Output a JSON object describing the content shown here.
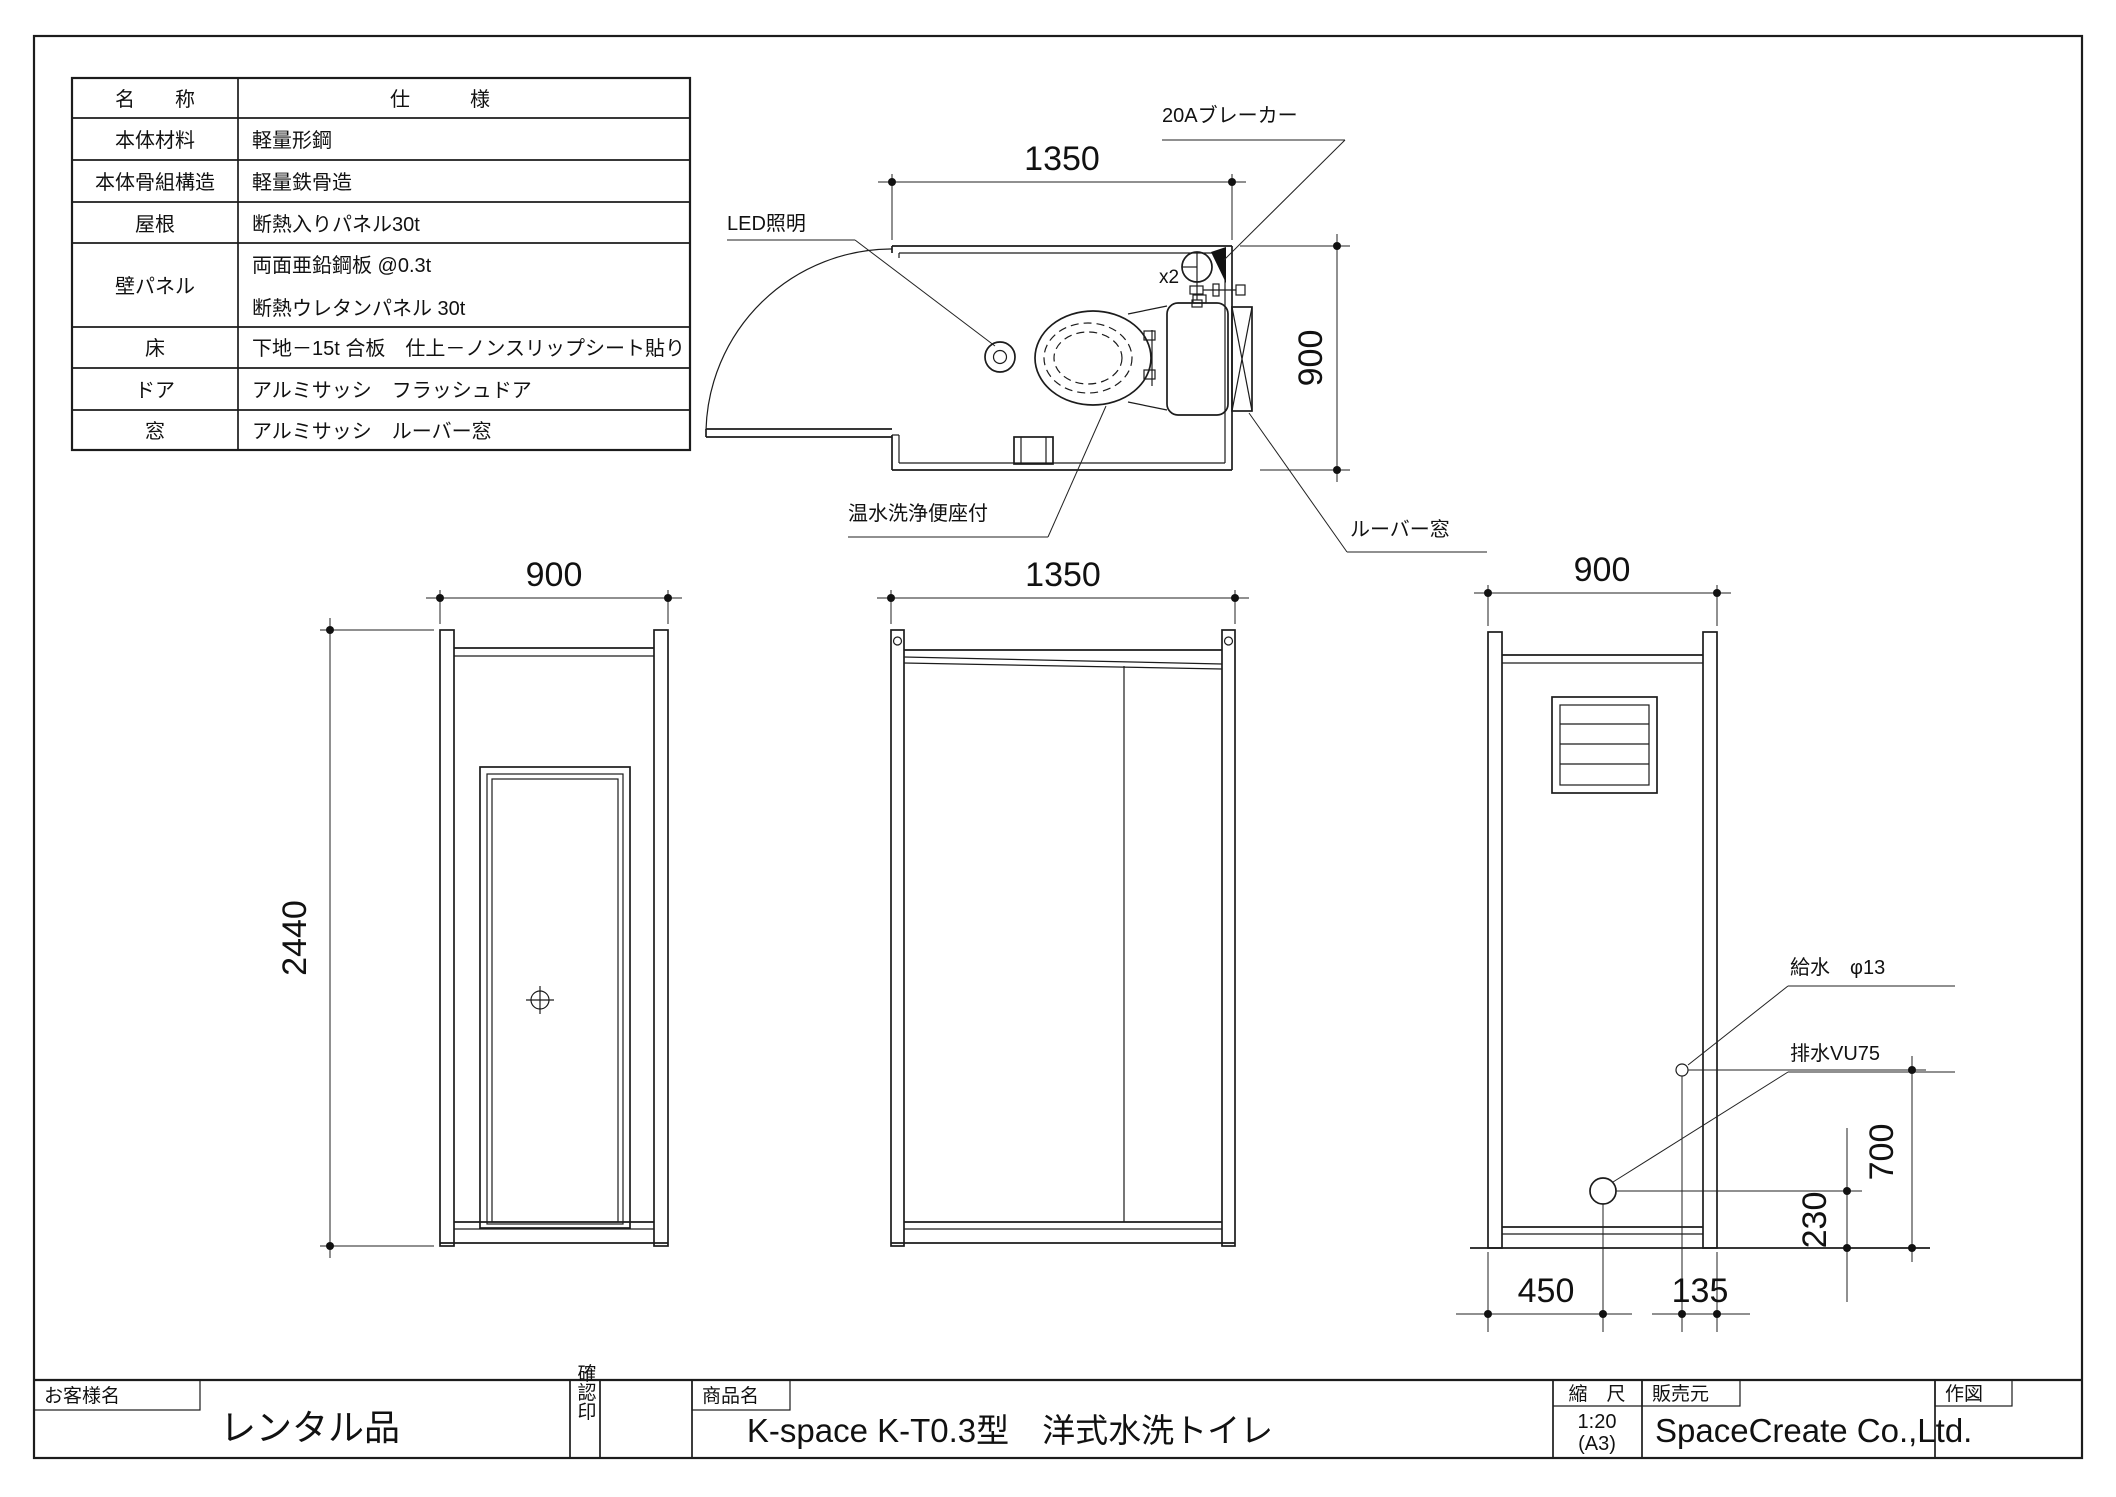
{
  "spec_table": {
    "headers": {
      "name": "名　　称",
      "spec": "仕　　　様"
    },
    "rows": [
      {
        "name": "本体材料",
        "spec": "軽量形鋼"
      },
      {
        "name": "本体骨組構造",
        "spec": "軽量鉄骨造"
      },
      {
        "name": "屋根",
        "spec": "断熱入りパネル30t"
      },
      {
        "name": "壁パネル",
        "spec_lines": [
          "両面亜鉛鋼板 @0.3t",
          "断熱ウレタンパネル 30t"
        ]
      },
      {
        "name": "床",
        "spec": "下地－15t 合板　仕上－ノンスリップシート貼り"
      },
      {
        "name": "ドア",
        "spec": "アルミサッシ　フラッシュドア"
      },
      {
        "name": "窓",
        "spec": "アルミサッシ　ルーバー窓"
      }
    ]
  },
  "plan_view": {
    "dim_width": "1350",
    "dim_depth": "900",
    "label_led": "LED照明",
    "label_breaker": "20Aブレーカー",
    "label_breaker_qty": "x2",
    "label_toilet": "温水洗浄便座付",
    "label_louver": "ルーバー窓"
  },
  "elevation_front": {
    "dim_width": "900",
    "dim_height": "2440"
  },
  "elevation_side": {
    "dim_width": "1350"
  },
  "elevation_rear": {
    "dim_width": "900",
    "label_supply": "給水　φ13",
    "label_drain": "排水VU75",
    "dim_700": "700",
    "dim_230": "230",
    "dim_450": "450",
    "dim_135": "135"
  },
  "title_block": {
    "customer_label": "お客様名",
    "customer_value": "レンタル品",
    "stamp_label": "確認印",
    "product_label": "商品名",
    "product_value": "K-space K-T0.3型　洋式水洗トイレ",
    "scale_label": "縮　尺",
    "scale_value": "1:20",
    "scale_paper": "(A3)",
    "seller_label": "販売元",
    "seller_value": "SpaceCreate Co.,Ltd.",
    "drawn_label": "作図"
  }
}
